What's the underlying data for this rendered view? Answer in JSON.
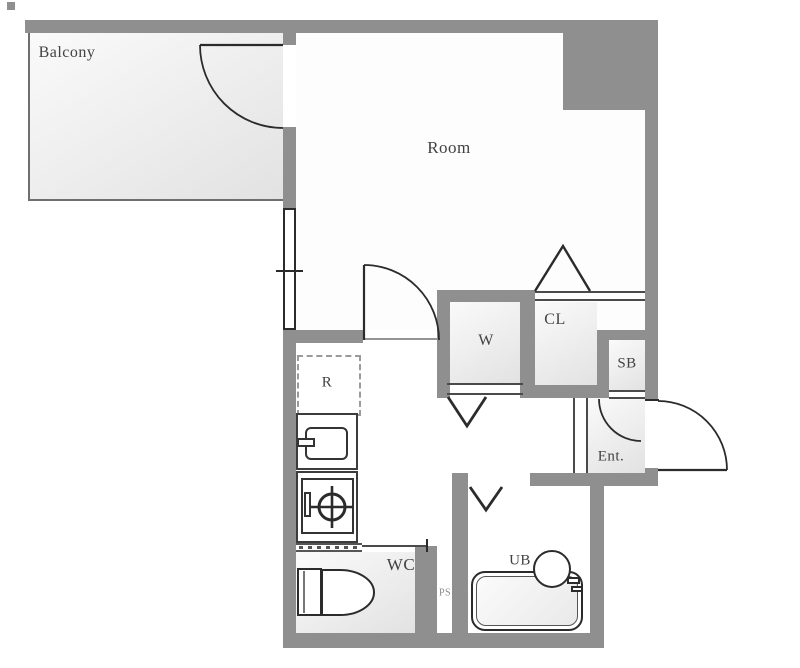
{
  "plan": {
    "title": "apartment-floor-plan",
    "areas": {
      "balcony": {
        "label": "Balcony"
      },
      "room": {
        "label": "Room"
      },
      "closet": {
        "label": "CL"
      },
      "washer": {
        "label": "W"
      },
      "shoe_box": {
        "label": "SB"
      },
      "entrance": {
        "label": "Ent."
      },
      "refrigerator": {
        "label": "R"
      },
      "toilet_room": {
        "label": "WC"
      },
      "pipe_space": {
        "label": "PS"
      },
      "unit_bath": {
        "label": "UB"
      }
    },
    "colors": {
      "wall": "#8f8f8f",
      "outline": "#2b2b2b",
      "label": "#424242",
      "fill_a": "#fafafa",
      "fill_b": "#e2e2e2"
    }
  }
}
